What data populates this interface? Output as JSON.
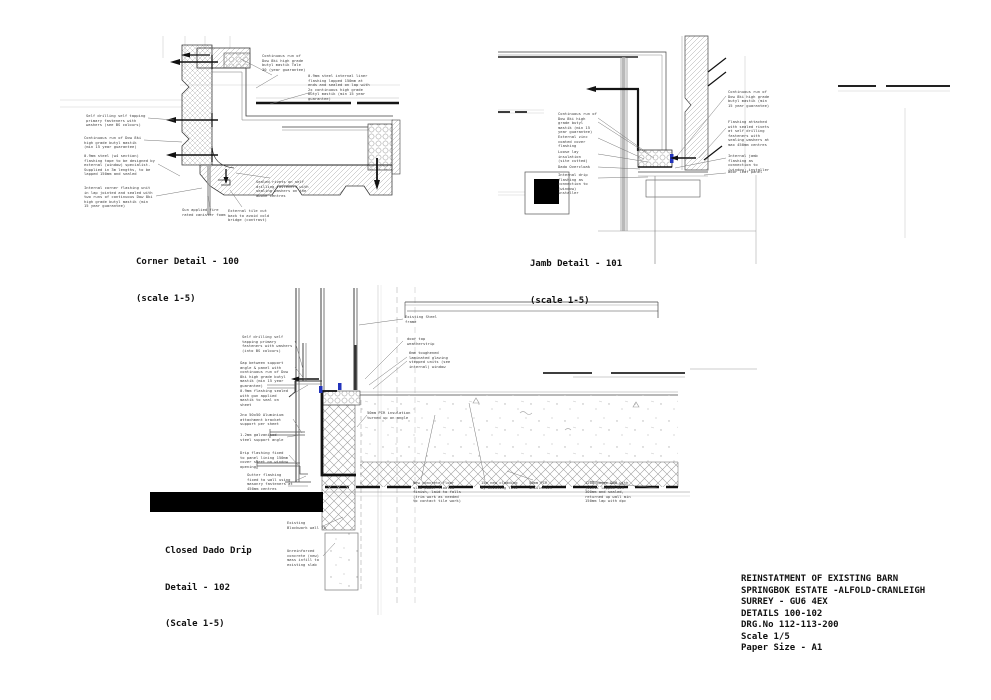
{
  "page": {
    "background_color": "#ffffff",
    "line_color": "#3c3c3c",
    "accent_blue": "#2233bb",
    "redaction_color": "#000000"
  },
  "title_block": {
    "lines": [
      "REINSTATMENT OF EXISTING BARN",
      "SPRINGBOK ESTATE -ALFOLD-CRANLEIGH",
      "SURREY - GU6 4EX",
      "DETAILS 100-102",
      "DRG.No 112-113-200",
      "Scale 1/5",
      "Paper Size - A1"
    ]
  },
  "details": {
    "corner": {
      "title": "Corner Detail - 100",
      "scale": "(scale 1-5)",
      "annotations": [
        "Self drilling self tapping primary fasteners with washers (see BS colours)",
        "Continuous run of Dow 8ki high grade butyl mastik (min 15 year guarantee)",
        "0.9mm steel (w4 section) flashing tape to be designed by external (window) specialist. Supplied in 3m lengths, to be lapped 150mm and sealed",
        "Internal corner flashing unit in lap jointed and sealed with two runs of continuous Dow 8ki high grade butyl mastik (min 15 year guarantee)",
        "Gun applied fire rated canister foam",
        "External tile cut back to avoid cold bridge (contrast)",
        "Sealed rivets on self drilling fasteners with sealing washers on the above centres",
        "Continuous run of Dow 8ki high grade butyl mastik Tale 30 (year guarantee)",
        "0.9mm steel internal liner flashing lapped 150mm at ends and sealed on lap with 2x continuous high grade butyl mastik (min 15 year guarantee)"
      ]
    },
    "jamb": {
      "title": "Jamb Detail - 101",
      "scale": "(scale 1-5)",
      "annotations": [
        "Continuous run of Dow 8ki high grade butyl mastik (min 15 year guarantee)",
        "External zinc coated cover flashing",
        "Loose lay insulation (site cutted)",
        "Dado Overcloak",
        "Internal drip flashing as connection to (window) installer",
        "Continuous run of Dow 8ki high grade butyl mastik (min 15 year guarantee)",
        "Flashing attached with sealed rivets at self drilling fasteners with sealing washers at max 450mm centres",
        "Internal jamb flashing as connection to (window) installer",
        "Door leaf panel"
      ]
    },
    "dado": {
      "title_line1": "Closed Dado Drip",
      "title_line2": "Detail - 102",
      "scale": "(Scale 1-5)",
      "annotations": [
        "Self drilling self tapping primary fasteners with washers (into BS colours)",
        "Gap between support angle & panel with continuous run of Dow 8ki high grade butyl mastik (min 15 year guarantee)",
        "0.9mm flashing sealed with gun applied mastik to seal on sheet",
        "2no 50x50 Aluminium attachment bracket support per sheet",
        "1.2mm galvanised steel support angle",
        "Drip flashing fixed to panel lining 150mm cover sheet on window opening",
        "Gutter flashing fixed to wall using masonry fasteners at 450mm centres",
        "50mm PIR insulation turned up on angle",
        "Existing Steel frame",
        "door top weatherstrip",
        "6mm toughened laminated glazing stepped units (see internal) window",
        "New concrete floor slab power floated finish, laid to falls (trim work as needed to contact tile work)",
        "15m new cladding by existing tile",
        "50mm PIR insulation",
        "1200 gauge DPM with joints lapped min 300mm and sealed, returned up wall min 150mm lap with dpc",
        "Existing Blockwork wall 75",
        "Unreinforced concrete (new) mass infill to existing slab"
      ]
    }
  }
}
